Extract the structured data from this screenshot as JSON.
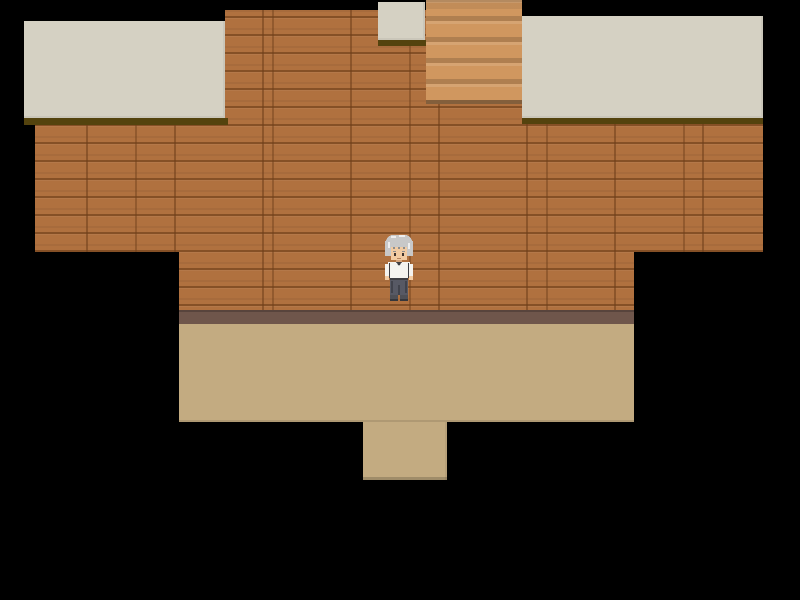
{
  "scene": {
    "setting": "top-down RPG interior room with wooden walls, staircase and floor, surrounded by black unexplored area",
    "background_color": "#000000",
    "palette": {
      "wood": "#b0713f",
      "ceiling": "#d5d1c3",
      "ceiling_shadow": "#54430e",
      "stairs": "#d0975f",
      "baseboard": "#6f564b",
      "floor": "#c3ab81"
    },
    "regions": {
      "wall_upper_mid": {
        "x": 225,
        "y": 10,
        "w": 201,
        "h": 242,
        "color": "wood"
      },
      "wall_under_stairs": {
        "x": 426,
        "y": 104,
        "w": 96,
        "h": 148,
        "color": "wood"
      },
      "wall_under_right_ceiling": {
        "x": 522,
        "y": 124,
        "w": 241,
        "h": 128,
        "color": "wood"
      },
      "wall_left": {
        "x": 35,
        "y": 125,
        "w": 190,
        "h": 127,
        "color": "wood"
      },
      "wall_lower": {
        "x": 179,
        "y": 252,
        "w": 455,
        "h": 58,
        "color": "wood"
      },
      "stairs": {
        "x": 426,
        "y": 0,
        "w": 96,
        "h": 104,
        "color": "stairs"
      },
      "baseboard": {
        "x": 179,
        "y": 310,
        "w": 455,
        "h": 14,
        "color": "baseboard"
      },
      "floor_main": {
        "x": 179,
        "y": 324,
        "w": 455,
        "h": 98,
        "color": "floor"
      },
      "floor_doorway_south": {
        "x": 363,
        "y": 422,
        "w": 84,
        "h": 58,
        "color": "floor"
      },
      "ceiling_left_shadow": {
        "x": 24,
        "y": 118,
        "w": 204,
        "h": 7,
        "color": "ceiling_shadow"
      },
      "ceiling_small_shadow": {
        "x": 378,
        "y": 40,
        "w": 48,
        "h": 6,
        "color": "ceiling_shadow"
      },
      "ceiling_right_shadow": {
        "x": 522,
        "y": 118,
        "w": 241,
        "h": 6,
        "color": "ceiling_shadow"
      },
      "ceiling_left": {
        "x": 24,
        "y": 21,
        "w": 201,
        "h": 97,
        "color": "ceiling"
      },
      "ceiling_small": {
        "x": 378,
        "y": 2,
        "w": 47,
        "h": 38,
        "color": "ceiling"
      },
      "ceiling_right": {
        "x": 522,
        "y": 16,
        "w": 241,
        "h": 102,
        "color": "ceiling"
      }
    }
  },
  "character": {
    "description": "elderly man sprite with silver-grey hair, white long-sleeved shirt, dark grey trousers and shoes, facing down",
    "x": 383,
    "y": 233,
    "w": 32,
    "h": 70,
    "colors": {
      "hair": "#c8c8c8",
      "hair_highlight": "#eeeeee",
      "hair_shadow": "#8e8e8e",
      "skin": "#f2cba2",
      "skin_shadow": "#d5a47a",
      "eye": "#40342e",
      "mouth": "#b5845f",
      "shirt": "#f4f3ef",
      "vest": "#3d3d42",
      "pants": "#575964",
      "pants_shadow": "#41434c",
      "shoes": "#4e4f55",
      "shoes_shadow": "#35363b"
    }
  }
}
